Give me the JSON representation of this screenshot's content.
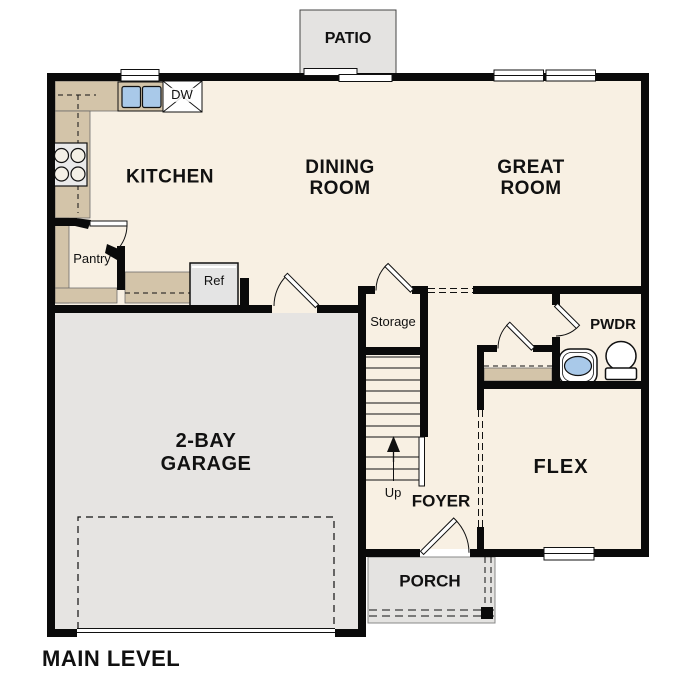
{
  "plan": {
    "title": "MAIN LEVEL",
    "rooms": {
      "kitchen": "KITCHEN",
      "dining": {
        "line1": "DINING",
        "line2": "ROOM"
      },
      "great": {
        "line1": "GREAT",
        "line2": "ROOM"
      },
      "garage": {
        "line1": "2-BAY",
        "line2": "GARAGE"
      },
      "flex": "FLEX",
      "foyer": "FOYER",
      "powder": "PWDR",
      "storage": "Storage",
      "pantry": "Pantry"
    },
    "outdoor": {
      "patio": "PATIO",
      "porch": "PORCH"
    },
    "fixtures": {
      "dishwasher": "DW",
      "refrigerator": "Ref"
    },
    "stairs": {
      "direction": "Up"
    },
    "colors": {
      "wall": "#0a0a0a",
      "floor": "#f8f0e3",
      "counter": "#d3c4a9",
      "garage_floor": "#e6e4e2",
      "outdoor_concrete": "#e4e3e1",
      "water": "#a9c9e9"
    }
  }
}
